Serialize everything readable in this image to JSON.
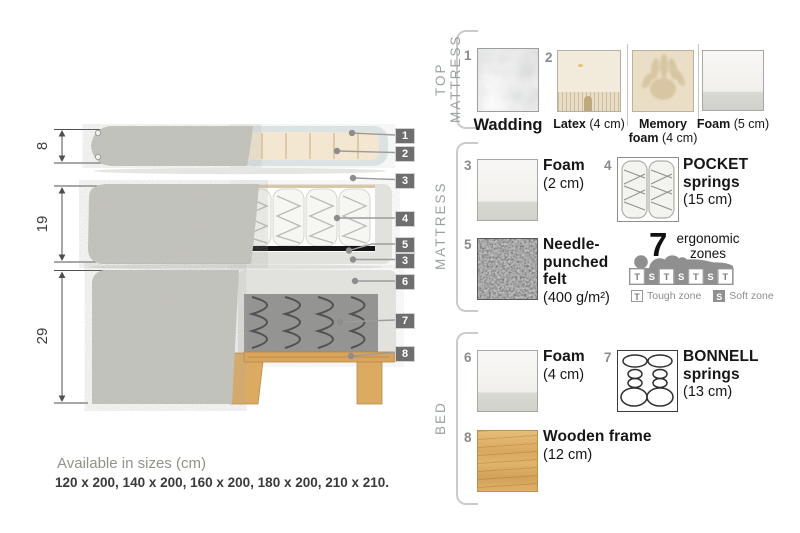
{
  "colors": {
    "callout_bg": "#6e6e6e",
    "fabric_gray": "#c7c7c0",
    "wadding_blue": "#e0e7e8",
    "latex_cream": "#f3e7d1",
    "felt_dark": "#4f4f4f",
    "bonnell_gray": "#949492",
    "wood": "#d9a75f",
    "section_label_gray": "#9aa1a1",
    "text_dark": "#161616"
  },
  "diagram": {
    "dim_top_mattress": "8",
    "dim_mattress": "19",
    "dim_bed": "29",
    "callouts": {
      "c1": "1",
      "c2": "2",
      "c3": "3",
      "c4": "4",
      "c5": "5",
      "c3b": "3",
      "c6": "6",
      "c7": "7",
      "c8": "8"
    }
  },
  "sizes": {
    "title": "Available in sizes (cm)",
    "list": "120 x 200, 140 x 200, 160 x 200, 180 x 200, 210 x 210."
  },
  "legend": {
    "top_mattress": {
      "label": "TOP MATTRESS",
      "wadding": {
        "num": "1",
        "name": "Wadding"
      },
      "latex": {
        "num": "2",
        "name": "Latex",
        "detail": "(4 cm)"
      },
      "memory": {
        "name": "Memory foam",
        "detail": "(4 cm)"
      },
      "foam": {
        "name": "Foam",
        "detail": "(5 cm)"
      }
    },
    "mattress": {
      "label": "MATTRESS",
      "foam": {
        "num": "3",
        "name": "Foam",
        "detail": "(2 cm)"
      },
      "pocket": {
        "num": "4",
        "name": "POCKET springs",
        "detail": "(15 cm)"
      },
      "felt": {
        "num": "5",
        "name": "Needle-punched felt",
        "detail": "(400 g/m²)"
      },
      "zones": {
        "count": "7",
        "label": "ergonomic zones",
        "cells": [
          "T",
          "S",
          "T",
          "S",
          "T",
          "S",
          "T"
        ],
        "tough_key": "T",
        "tough_label": "Tough zone",
        "soft_key": "S",
        "soft_label": "Soft zone"
      }
    },
    "bed": {
      "label": "BED",
      "foam": {
        "num": "6",
        "name": "Foam",
        "detail": "(4 cm)"
      },
      "bonnell": {
        "num": "7",
        "name": "BONNELL springs",
        "detail": "(13 cm)"
      },
      "frame": {
        "num": "8",
        "name": "Wooden frame",
        "detail": "(12 cm)"
      }
    }
  }
}
